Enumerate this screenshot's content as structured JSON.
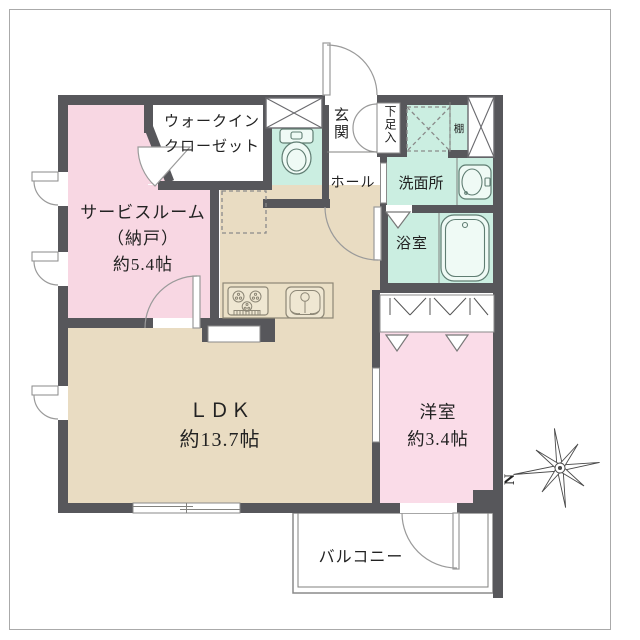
{
  "title": "apartment-floor-plan",
  "colors": {
    "wall": "#57575b",
    "room_pink": "#f8d7e3",
    "room_pink_light": "#fadce8",
    "room_beige": "#e9dcc2",
    "room_teal": "#cbeee1",
    "line": "#82827f",
    "text": "#222222",
    "frame": "#aaaaaa"
  },
  "rooms": {
    "service_room": {
      "name": "サービスルーム",
      "name_sub": "（納戸）",
      "size": "約5.4帖"
    },
    "walk_in_closet": {
      "line1": "ウォークイン",
      "line2": "クローゼット"
    },
    "entrance": {
      "label": "玄関"
    },
    "shoe_cabinet": {
      "label": "下足入"
    },
    "shelf": {
      "label": "棚"
    },
    "hall": {
      "label": "ホール"
    },
    "washroom": {
      "label": "洗面所"
    },
    "bathroom": {
      "label": "浴室"
    },
    "ldk": {
      "label": "ＬＤＫ",
      "size": "約13.7帖"
    },
    "western_room": {
      "label": "洋室",
      "size": "約3.4帖"
    },
    "balcony": {
      "label": "バルコニー"
    }
  },
  "compass": {
    "label": "N"
  },
  "fixtures": [
    "toilet",
    "bathtub",
    "washbasin",
    "kitchen-stove",
    "kitchen-sink",
    "washing-machine-space",
    "refrigerator-space",
    "pillar",
    "shelf",
    "closet-hanger-pipe",
    "shoe-cabinet-doors",
    "casement-window",
    "sliding-window",
    "swing-door",
    "folding-door",
    "compass-north"
  ]
}
